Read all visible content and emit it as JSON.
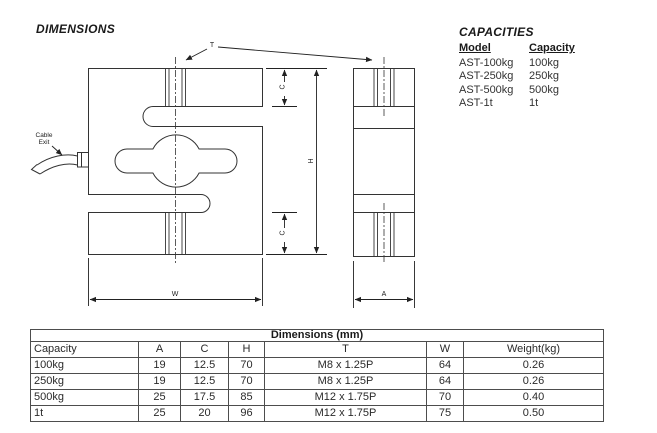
{
  "headings": {
    "dimensions": "DIMENSIONS",
    "capacities": "CAPACITIES"
  },
  "capacities": {
    "col_model": "Model",
    "col_capacity": "Capacity",
    "rows": [
      {
        "model": "AST-100kg",
        "capacity": "100kg"
      },
      {
        "model": "AST-250kg",
        "capacity": "250kg"
      },
      {
        "model": "AST-500kg",
        "capacity": "500kg"
      },
      {
        "model": "AST-1t",
        "capacity": "1t"
      }
    ]
  },
  "drawing": {
    "labels": {
      "t": "T",
      "c_top": "C",
      "c_bottom": "C",
      "h": "H",
      "w": "W",
      "a": "A",
      "cable_line1": "Cable",
      "cable_line2": "Exit"
    },
    "line_color": "#333333"
  },
  "dim_table": {
    "title": "Dimensions (mm)",
    "headers": [
      "Capacity",
      "A",
      "C",
      "H",
      "T",
      "W",
      "Weight(kg)"
    ],
    "rows": [
      [
        "100kg",
        "19",
        "12.5",
        "70",
        "M8 x 1.25P",
        "64",
        "0.26"
      ],
      [
        "250kg",
        "19",
        "12.5",
        "70",
        "M8 x 1.25P",
        "64",
        "0.26"
      ],
      [
        "500kg",
        "25",
        "17.5",
        "85",
        "M12 x 1.75P",
        "70",
        "0.40"
      ],
      [
        "1t",
        "25",
        "20",
        "96",
        "M12 x 1.75P",
        "75",
        "0.50"
      ]
    ]
  }
}
